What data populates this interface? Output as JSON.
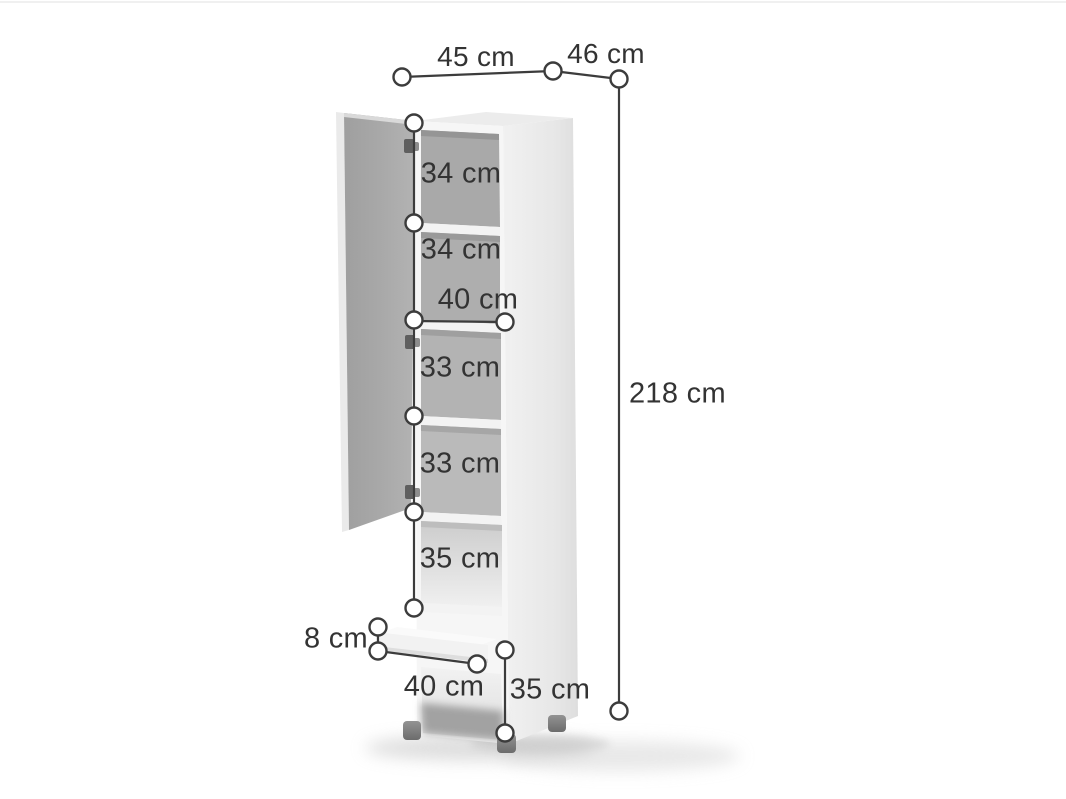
{
  "diagram": {
    "description": "Tall storage cabinet dimension diagram with open door, five shelf compartments, drawer and open base compartment",
    "unit": "cm",
    "dimensions": {
      "width_top": "45 cm",
      "depth_top": "46 cm",
      "total_height": "218 cm",
      "compartment_1_height": "34 cm",
      "compartment_2_height": "34 cm",
      "interior_width": "40 cm",
      "compartment_3_height": "33 cm",
      "compartment_4_height": "33 cm",
      "compartment_5_height": "35 cm",
      "drawer_front_height": "8 cm",
      "drawer_width": "40 cm",
      "base_compartment_height": "35 cm"
    },
    "colors": {
      "dimension_line": "#3c3c3c",
      "label_text": "#333333",
      "cabinet_body": "#f6f6f6",
      "cabinet_side": "#e8e8e8",
      "door_inner_face": "#a9a9a9",
      "interior_back": "#b0b0b0",
      "feet": "#7d7d7d",
      "background": "#ffffff"
    }
  }
}
